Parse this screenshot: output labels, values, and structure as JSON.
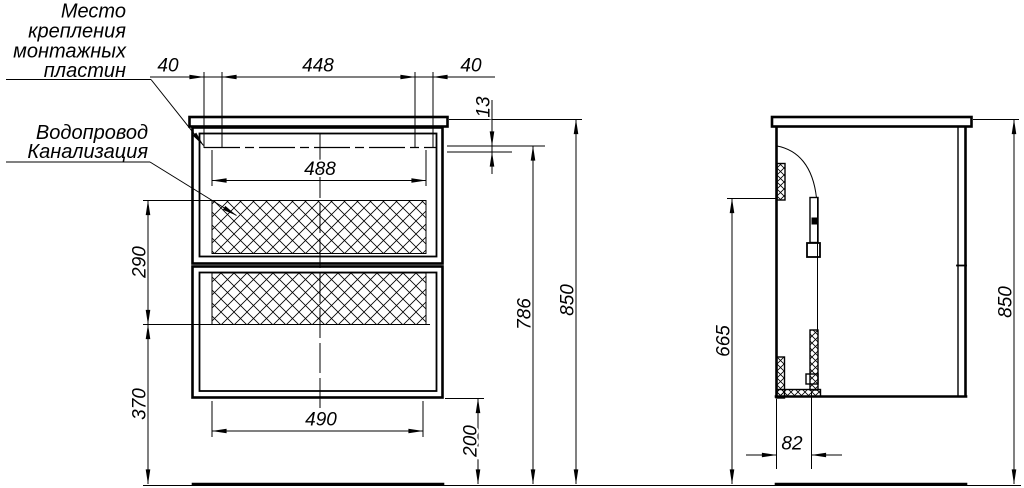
{
  "annotations": {
    "mounting_note": {
      "lines": [
        "Место",
        "крепления",
        "монтажных",
        "пластин"
      ]
    },
    "plumbing_note": {
      "lines": [
        "Водопровод",
        "Канализация"
      ]
    }
  },
  "front_view": {
    "dims": {
      "offset_left": "40",
      "plate_span": "448",
      "offset_right": "40",
      "top_gap": "13",
      "inner_width": "488",
      "service_zone_height": "290",
      "below_zone_height": "370",
      "drawer_width": "490",
      "bottom_clearance": "200",
      "mount_line_height": "786",
      "total_height": "850"
    }
  },
  "side_view": {
    "dims": {
      "mount_height": "665",
      "recess_depth": "82",
      "total_height": "850"
    }
  },
  "colors": {
    "line": "#000000",
    "background": "#ffffff"
  }
}
